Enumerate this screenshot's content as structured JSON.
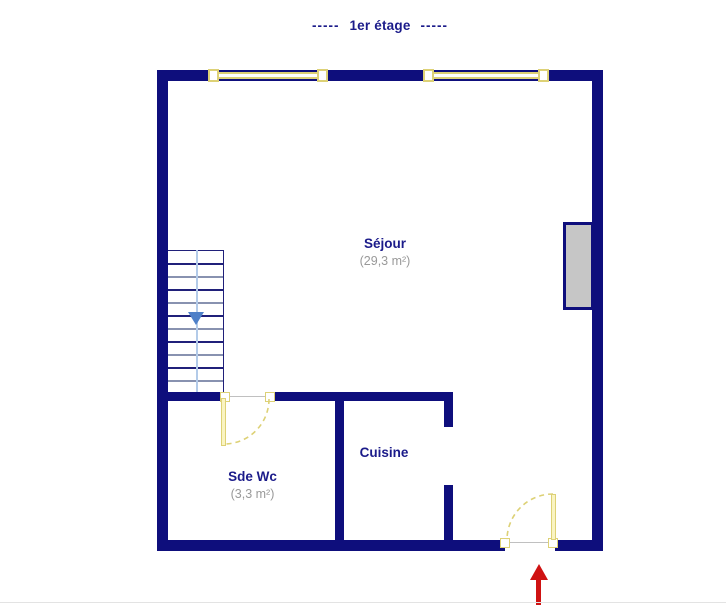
{
  "floor_plan": {
    "title": {
      "dash_left": "-----",
      "text": "1er étage",
      "dash_right": "-----"
    },
    "rooms": {
      "sejour": {
        "name": "Séjour",
        "area": "(29,3 m²)"
      },
      "cuisine": {
        "name": "Cuisine"
      },
      "sde_wc": {
        "name": "Sde Wc",
        "area": "(3,3 m²)"
      }
    },
    "stairs": {
      "steps": 10,
      "direction": "down"
    },
    "colors": {
      "wall": "#0e0e7c",
      "window": "#ddd176",
      "label": "#1b1b8a",
      "area_text": "#999999",
      "stair_arrow": "#4e80c8",
      "guide_line": "#b3cbe9",
      "tread_dark": "#20207a",
      "tread_light": "#8892b0",
      "entrance_arrow": "#cf1212",
      "panel_fill": "#c6c6c6",
      "opening_line": "#c0c0c0"
    }
  }
}
